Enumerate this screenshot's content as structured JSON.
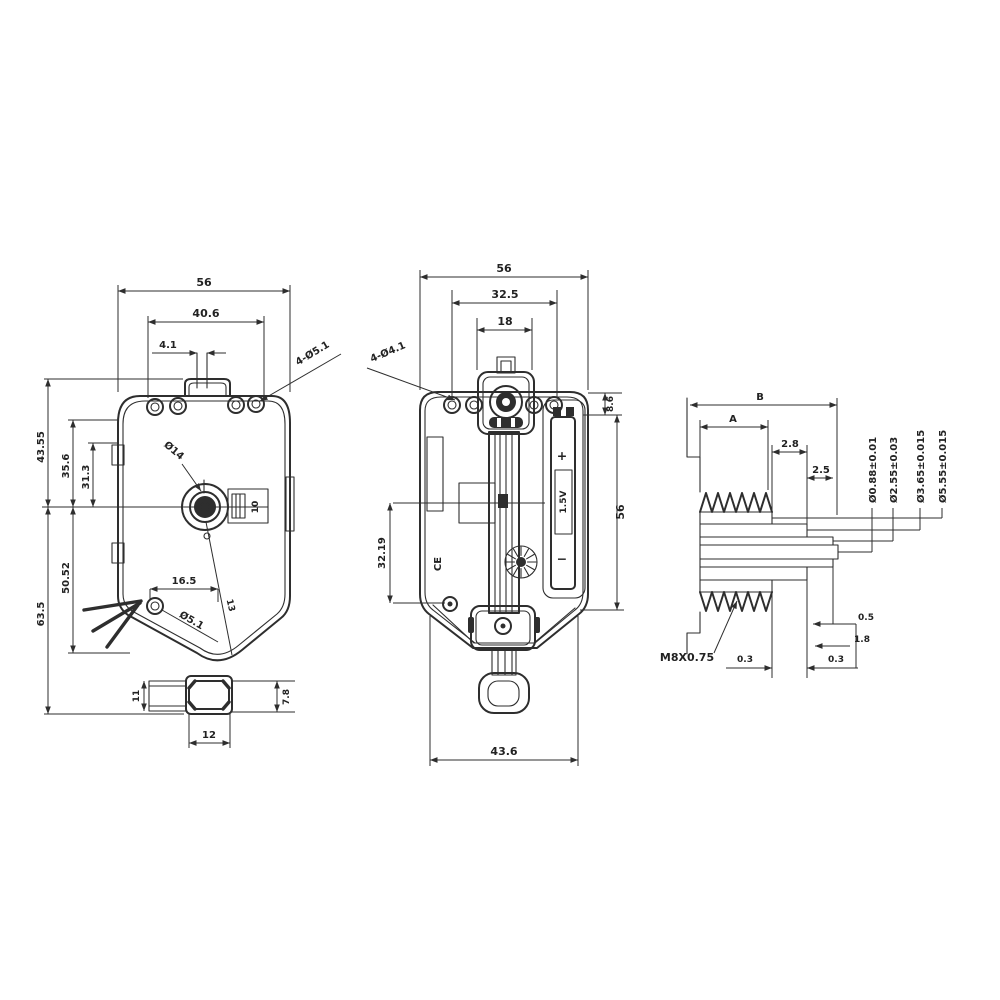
{
  "drawing": {
    "type": "engineering drawing - quartz pendulum clock movement, three views",
    "line_color": "#2e2e2e",
    "background": "#ffffff"
  },
  "front_view": {
    "dim_width_top": "56",
    "dim_width_inner": "40.6",
    "dim_slot": "4.1",
    "label_top_holes": "4-Ø5.1",
    "dim_upper_height": "43.55",
    "dim_35_6": "35.6",
    "dim_31_3": "31.3",
    "dim_lower_height": "63.5",
    "dim_50_52": "50.52",
    "dim_hole_offset": "16.5",
    "label_hole_dia": "Ø5.1",
    "label_shaft_dia": "Ø14",
    "dim_boss": "10",
    "dim_13": "13",
    "dim_tab": "11",
    "dim_hanger_width": "12",
    "dim_hanger_height": "7.8"
  },
  "side_view": {
    "dim_width_top": "56",
    "dim_width_inner": "32.5",
    "dim_knob": "18",
    "label_top_holes": "4-Ø4.1",
    "dim_top_offset": "8.6",
    "dim_height": "56",
    "dim_shaft_span": "32.19",
    "dim_bottom_width": "43.6",
    "battery_plus": "+",
    "battery_voltage": "1.5V",
    "battery_minus": "−",
    "ce_mark": "CE"
  },
  "detail_view": {
    "dim_b": "B",
    "dim_a": "A",
    "dim_2_8": "2.8",
    "dim_2_5": "2.5",
    "dia_core": "Ø0.88±0.01",
    "dia_2": "Ø2.55±0.03",
    "dia_3": "Ø3.65±0.015",
    "dia_4": "Ø5.55±0.015",
    "dim_0_5": "0.5",
    "dim_1_8": "1.8",
    "dim_0_3_left": "0.3",
    "dim_0_3_right": "0.3",
    "label_thread": "M8X0.75"
  }
}
